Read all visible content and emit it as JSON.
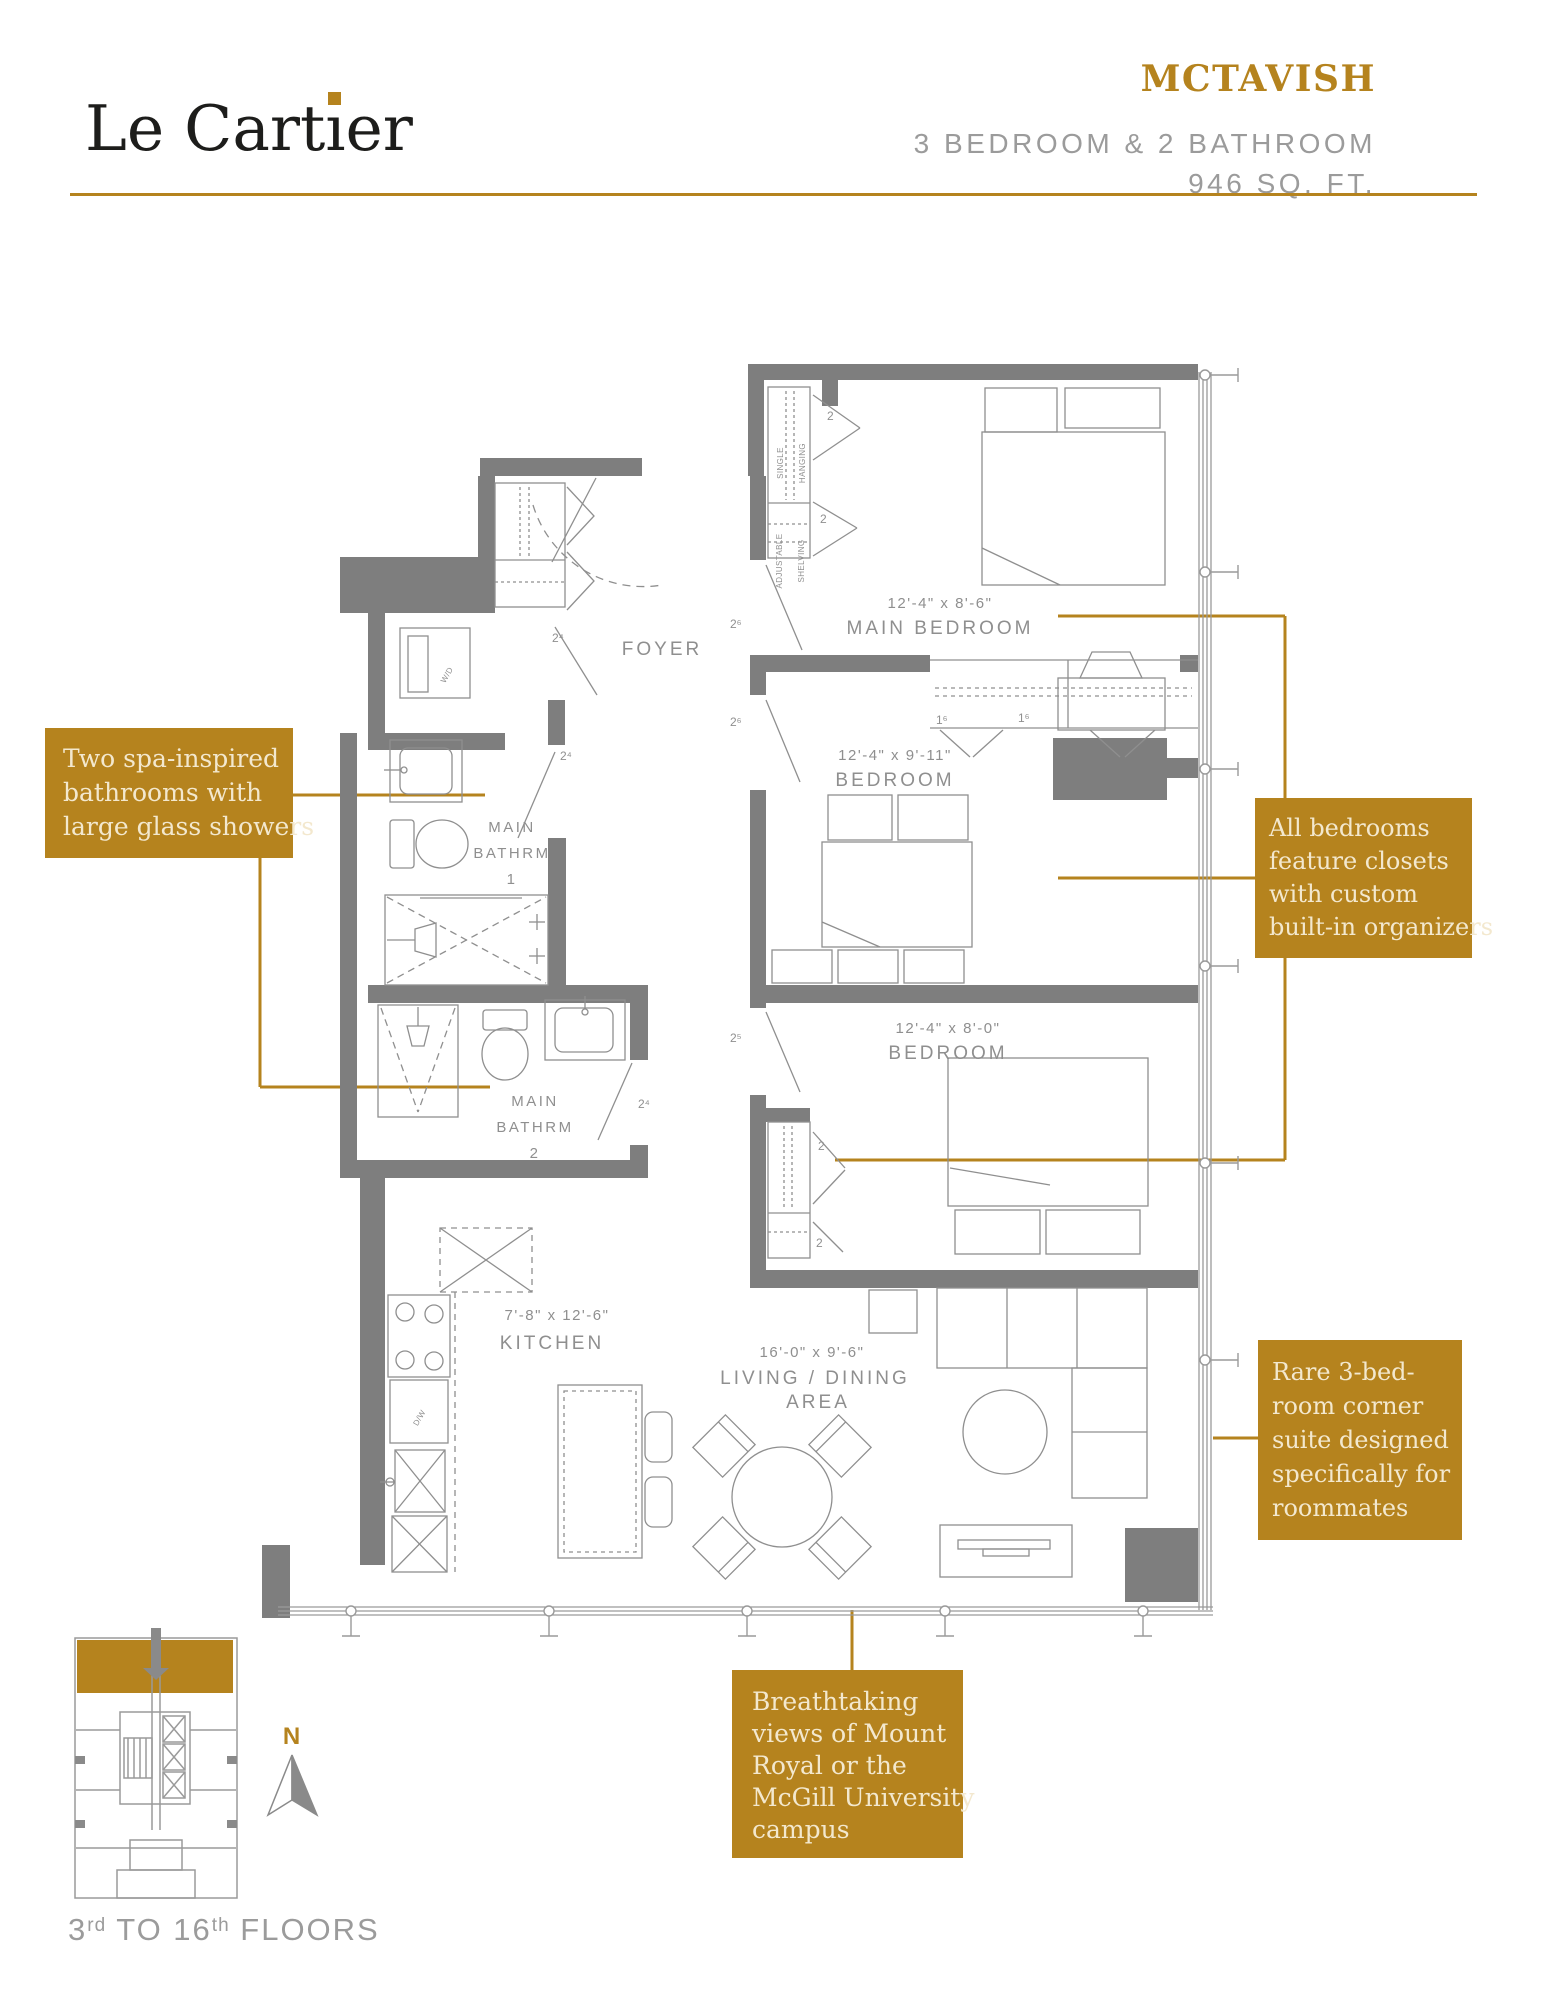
{
  "colors": {
    "gold": "#B5831E",
    "cream": "#F3E8CE",
    "wall": "#7E7E7E",
    "line": "#9A9A9A",
    "text_gray": "#8F8F8F",
    "ink": "#1D1D1B",
    "subtitle_gray": "#9B9B9B"
  },
  "header": {
    "brand_pre": "Le Cart",
    "brand_i": "ı",
    "brand_post": "er",
    "unit_name": "MCTAVISH",
    "spec_line": "3 BEDROOM & 2 BATHROOM",
    "area_line": "946 SQ. FT."
  },
  "callouts": {
    "bathrooms": {
      "lines": [
        "Two spa-inspired",
        "bathrooms with",
        "large glass showers"
      ]
    },
    "closets": {
      "lines": [
        "All bedrooms",
        "feature closets",
        "with custom",
        "built-in organizers"
      ]
    },
    "corner": {
      "lines": [
        "Rare 3-bed-",
        "room corner",
        "suite designed",
        "specifically for",
        "roommates"
      ]
    },
    "views": {
      "lines": [
        "Breathtaking",
        "views of Mount",
        "Royal or the",
        "McGill University",
        "campus"
      ]
    }
  },
  "plan": {
    "foyer": "FOYER",
    "main_bedroom_dims": "12'-4\" x 8'-6\"",
    "main_bedroom": "MAIN BEDROOM",
    "bedroom2_dims": "12'-4\" x 9'-11\"",
    "bedroom2": "BEDROOM",
    "bedroom3_dims": "12'-4\" x 8'-0\"",
    "bedroom3": "BEDROOM",
    "kitchen_dims": "7'-8\" x 12'-6\"",
    "kitchen": "KITCHEN",
    "living_dims": "16'-0\" x 9'-6\"",
    "living1": "LIVING / DINING",
    "living2": "AREA",
    "bath1_l1": "MAIN",
    "bath1_l2": "BATHRM",
    "bath1_l3": "1",
    "bath2_l1": "MAIN",
    "bath2_l2": "BATHRM",
    "bath2_l3": "2",
    "closet_hang1": "SINGLE",
    "closet_hang2": "HANGING",
    "closet_shelf1": "ADJUSTABLE",
    "closet_shelf2": "SHELVING",
    "washer": "W/D",
    "dishwasher": "D/W",
    "doors": {
      "main_bedroom": "2⁶",
      "bedroom2": "2⁶",
      "bedroom3": "2⁵",
      "bath1": "2⁴",
      "bath2": "2⁴",
      "laundry": "2⁴",
      "closet_a": "2",
      "closet_b": "2",
      "closet3_a": "2",
      "closet3_b": "2",
      "closet2_a": "1⁶",
      "closet2_b": "1⁶"
    }
  },
  "keyplan": {
    "floors_pre": "3",
    "floors_sup1": "rd",
    "floors_mid": " TO 16",
    "floors_sup2": "th",
    "floors_post": " FLOORS",
    "north": "N"
  }
}
